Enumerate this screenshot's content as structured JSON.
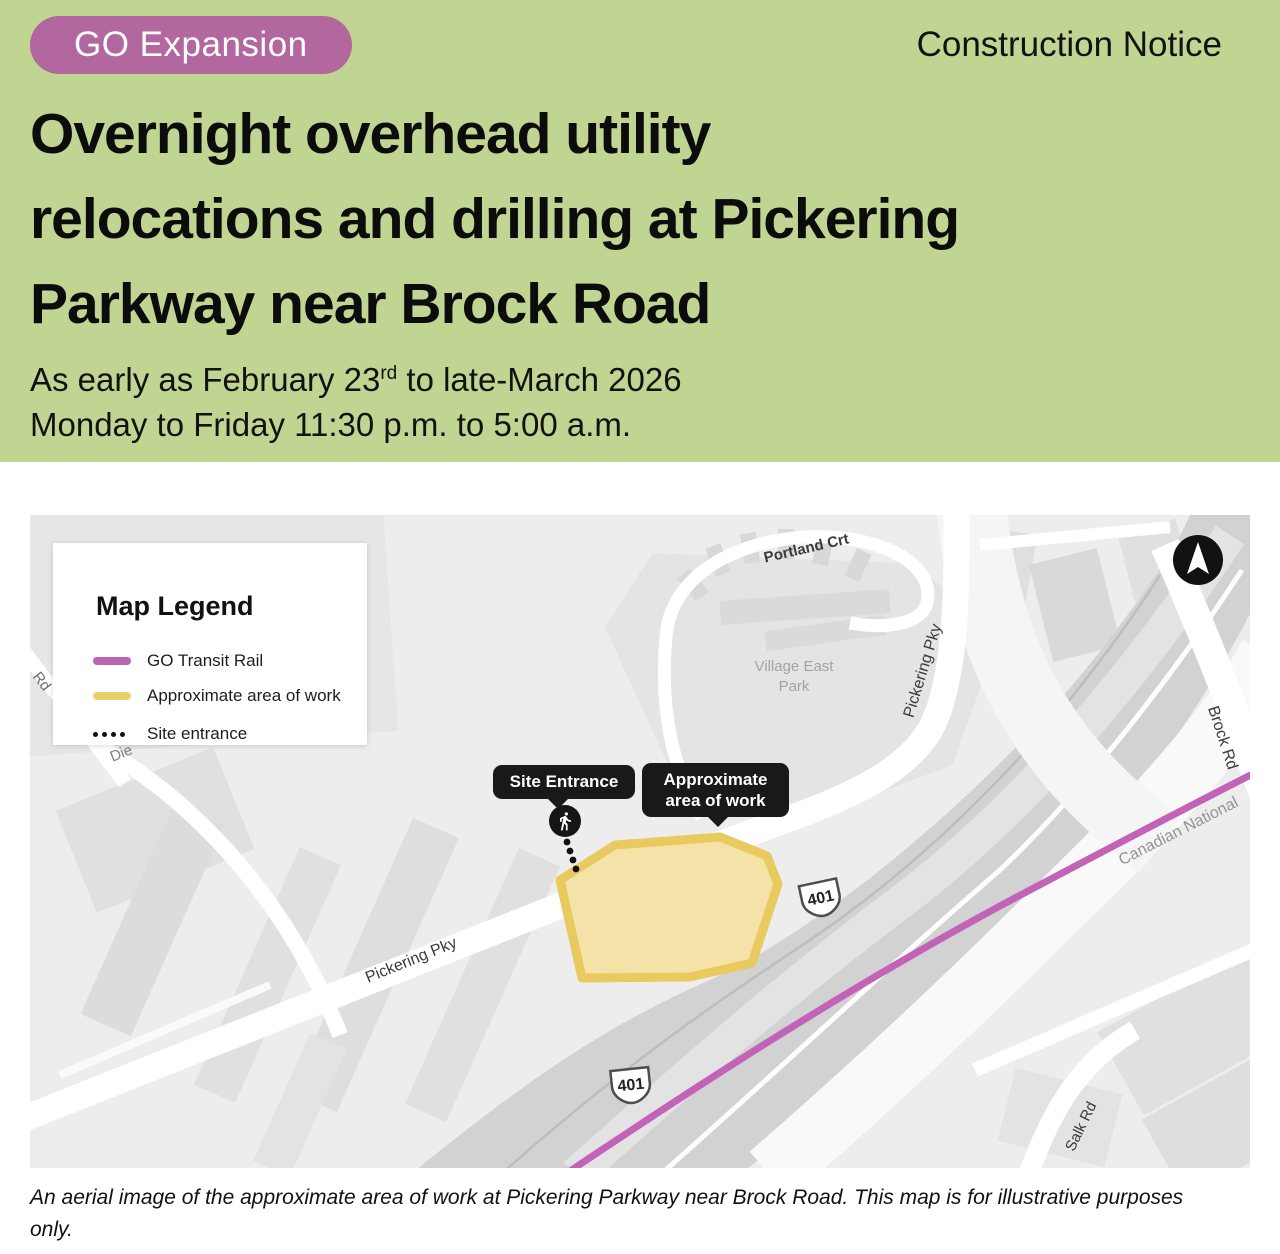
{
  "header": {
    "badge": "GO Expansion",
    "notice_type": "Construction Notice",
    "title_lines": [
      "Overnight overhead utility",
      "relocations and drilling at Pickering",
      "Parkway near Brock Road"
    ],
    "date_prefix": "As early as February 23",
    "date_superscript": "rd",
    "date_suffix": " to late-March 2026",
    "schedule": "Monday to Friday 11:30 p.m. to 5:00 a.m."
  },
  "map": {
    "legend": {
      "title": "Map Legend",
      "items": [
        {
          "label": "GO Transit Rail",
          "swatch": "rail-line",
          "color": "#b864ae"
        },
        {
          "label": "Approximate area of work",
          "swatch": "work-area",
          "color": "#e8d06b"
        },
        {
          "label": "Site entrance",
          "swatch": "dotted-trail",
          "color": "#111111"
        }
      ]
    },
    "labels": {
      "portland_crt": "Portland Crt",
      "village_east_park": "Village East Park",
      "pickering_pky_upper": "Pickering Pky",
      "pickering_pky_lower": "Pickering Pky",
      "brock_rd": "Brock Rd",
      "canadian_national": "Canadian National",
      "salk_rd": "Salk Rd",
      "rd_partial": "Rd",
      "die_partial": "Die"
    },
    "highway_shield": "401",
    "tooltips": {
      "site_entrance": "Site Entrance",
      "work_area": "Approximate area of work"
    },
    "icons": {
      "north_arrow": "compass-north-arrow",
      "pedestrian": "walking-person"
    },
    "colors": {
      "rail_line": "#c263b8",
      "work_fill": "#f5e2a8",
      "work_border": "#e9ca5e",
      "header_bg": "#c1d593",
      "badge_bg": "#b2679e"
    }
  },
  "caption": "An aerial image of the approximate area of work at Pickering Parkway near Brock Road. This map is for illustrative purposes only."
}
